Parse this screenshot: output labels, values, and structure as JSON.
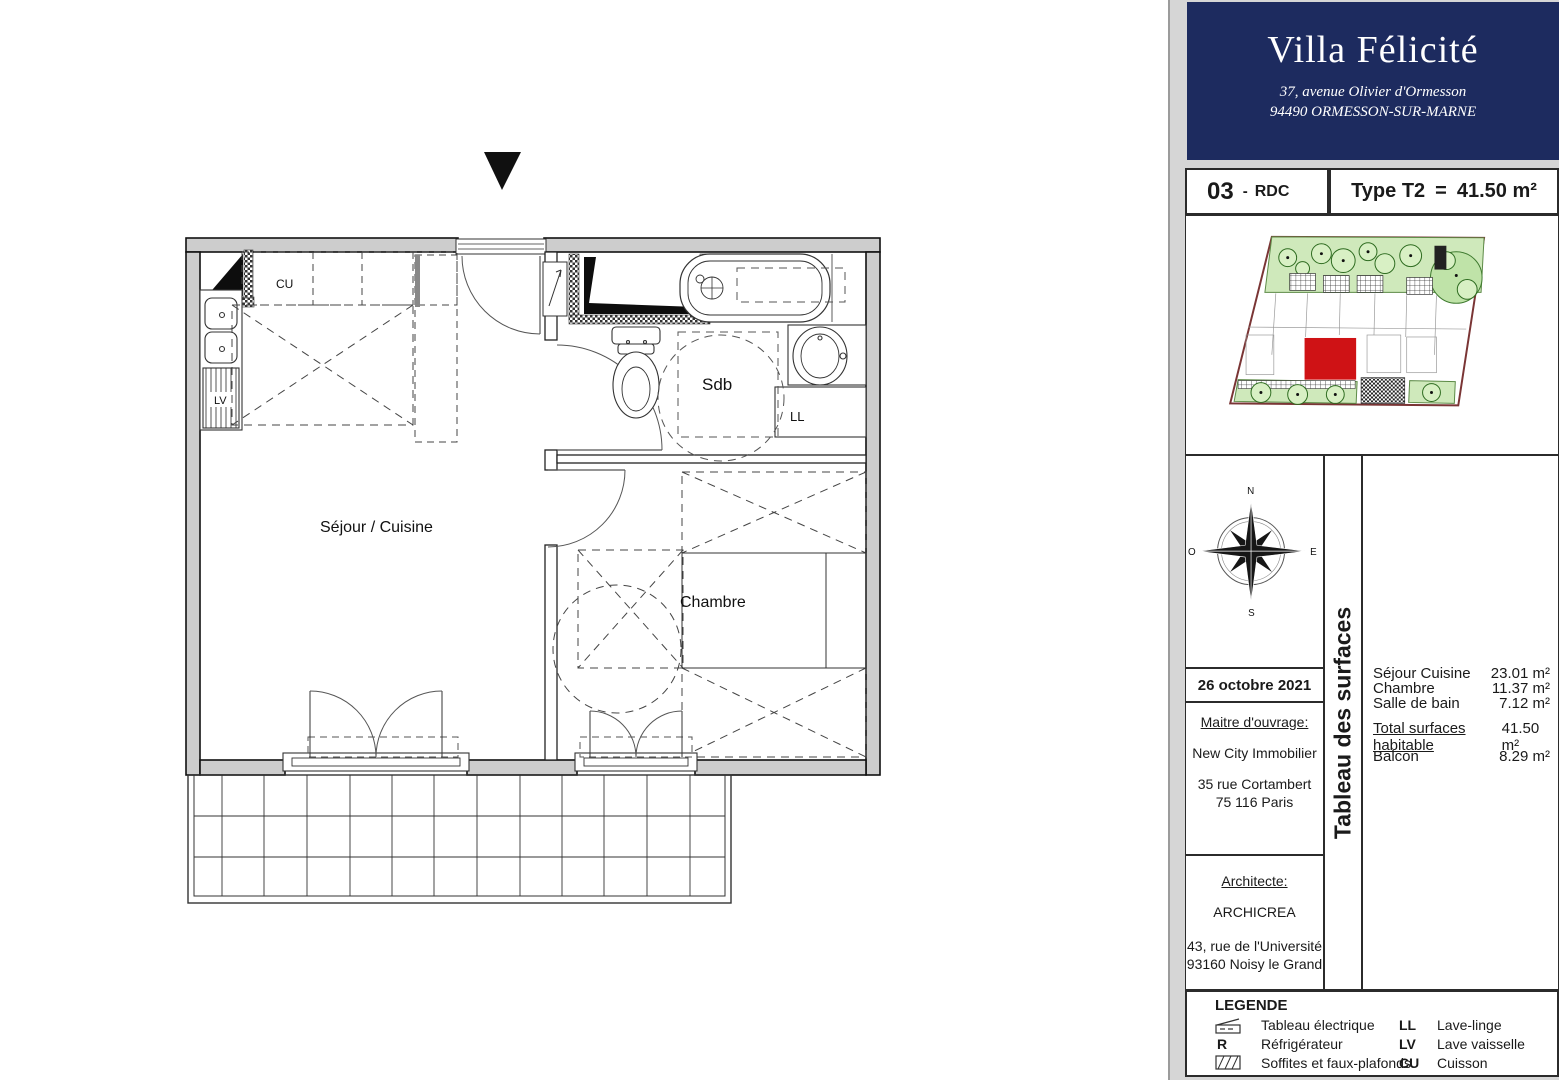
{
  "header": {
    "title": "Villa Félicité",
    "address_line1": "37, avenue Olivier d'Ormesson",
    "address_line2": "94490 ORMESSON-SUR-MARNE"
  },
  "unit": {
    "number": "03",
    "dash": "-",
    "floor": "RDC",
    "type": "Type T2",
    "equals": "=",
    "area": "41.50 m²"
  },
  "plan_labels": {
    "sejour": "Séjour / Cuisine",
    "chambre": "Chambre",
    "sdb": "Sdb",
    "cu": "CU",
    "lv": "LV",
    "ll": "LL"
  },
  "compass": {
    "n": "N",
    "s": "S",
    "e": "E",
    "o": "O"
  },
  "date": "26 octobre 2021",
  "maitre": {
    "heading": "Maitre d'ouvrage:",
    "name": "New City Immobilier",
    "address_line1": "35 rue Cortambert",
    "address_line2": "75 116 Paris"
  },
  "architecte": {
    "heading": "Architecte:",
    "name": "ARCHICREA",
    "address_line1": "43, rue de l'Université",
    "address_line2": "93160 Noisy le Grand"
  },
  "surfaces": {
    "sidebar_title": "Tableau des surfaces",
    "rows": [
      {
        "label": "Séjour Cuisine",
        "value": "23.01 m²"
      },
      {
        "label": "Chambre",
        "value": "11.37 m²"
      },
      {
        "label": "Salle de bain",
        "value": "7.12 m²"
      }
    ],
    "total": {
      "label": "Total surfaces habitable",
      "value": "41.50 m²"
    },
    "balcon": {
      "label": "Balcon",
      "value": "8.29 m²"
    }
  },
  "legend": {
    "title": "LEGENDE",
    "left": [
      {
        "symbol": "",
        "label": "Tableau électrique"
      },
      {
        "symbol": "R",
        "label": "Réfrigérateur"
      },
      {
        "symbol": "",
        "label": "Soffites et faux-plafonds"
      }
    ],
    "right": [
      {
        "symbol": "LL",
        "label": "Lave-linge"
      },
      {
        "symbol": "LV",
        "label": "Lave vaisselle"
      },
      {
        "symbol": "CU",
        "label": "Cuisson"
      }
    ]
  },
  "colors": {
    "navy": "#1d2b5f",
    "highlight_red": "#cf1215",
    "garden_green": "#cfe9bb",
    "wall_gray": "#cdcdcd",
    "panel_gray": "#d6d6d6"
  }
}
